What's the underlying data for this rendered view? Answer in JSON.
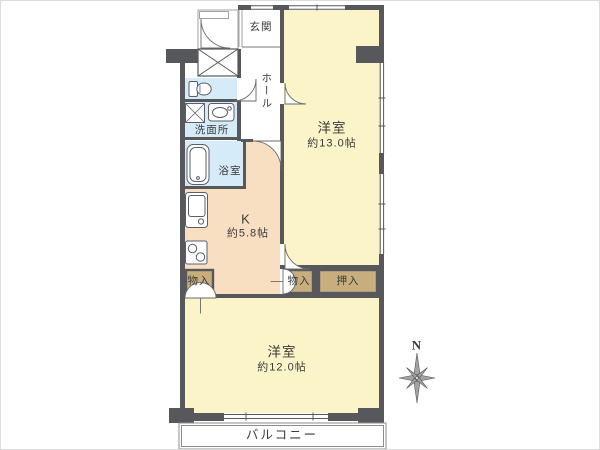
{
  "plan": {
    "type": "apartment-floorplan",
    "rooms": {
      "genkan": {
        "label": "玄関"
      },
      "hall": {
        "label": "ホール"
      },
      "washroom": {
        "label": "洗面所"
      },
      "bathroom": {
        "label": "浴室"
      },
      "kitchen": {
        "label": "K",
        "size": "約5.8帖"
      },
      "bedroom1": {
        "label": "洋室",
        "size": "約13.0帖"
      },
      "bedroom2": {
        "label": "洋室",
        "size": "約12.0帖"
      },
      "storage_left": {
        "label": "物入"
      },
      "storage_mid": {
        "label": "物入"
      },
      "oshiire": {
        "label": "押入"
      },
      "balcony": {
        "label": "バルコニー"
      }
    },
    "compass": {
      "label": "N"
    },
    "fixtures": [
      "toilet",
      "washing-machine-pan",
      "washbasin",
      "bathtub",
      "kitchen-sink",
      "stove"
    ]
  },
  "colors": {
    "room_yellow": "#FAF4C8",
    "kitchen_peach": "#F8DFC2",
    "wet_blue": "#D5EBF7",
    "closet_tan": "#C8AE7D",
    "wall_gray": "#57585B",
    "text": "#3A3A3A"
  }
}
